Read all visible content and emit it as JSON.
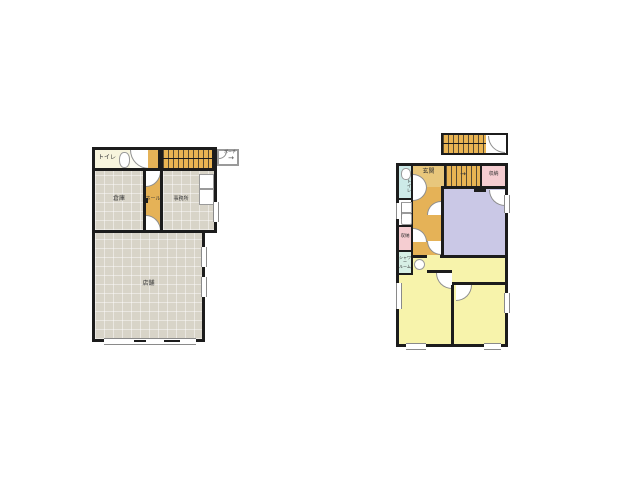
{
  "colors": {
    "wall": "#1c1c1c",
    "floor_gray": "#d8d4c8",
    "stair_orange": "#e9b453",
    "hall_orange": "#e5b257",
    "genkan_tan": "#e8c77c",
    "toilet_cream": "#f7f4dd",
    "toilet_cyan": "#cdeae8",
    "storage_pink": "#f5cdd1",
    "room_purple": "#cac8e6",
    "room_yellow": "#f7f3ab",
    "shower_mint": "#d6efe5"
  },
  "floor1": {
    "toilet": "トイレ",
    "warehouse": "倉庫",
    "hall": "ホール",
    "office": "事務所",
    "shop": "店舗",
    "porch": "ポーチ",
    "porch_arrow": "→"
  },
  "floor2": {
    "toilet": "トイレ",
    "entrance": "玄関",
    "storage_upper": "収納",
    "storage_lower": "収納",
    "shower": "シャワー\nルーム",
    "stairs_arrow": "→"
  }
}
